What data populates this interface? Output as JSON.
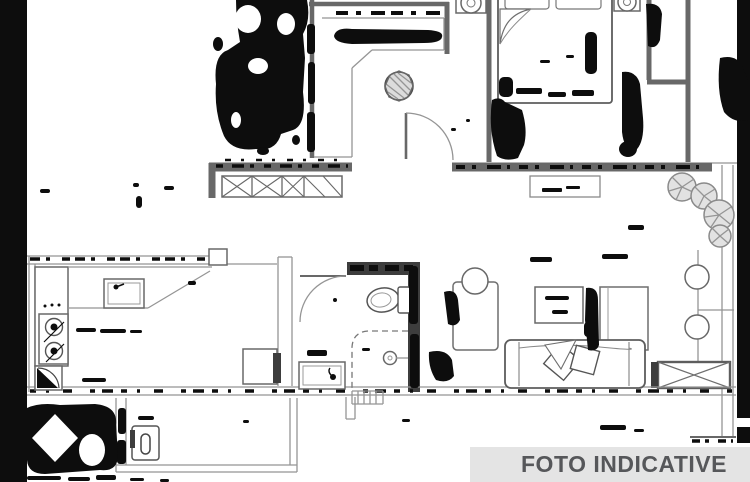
{
  "image": {
    "kind": "apartment floor plan, scanned pencil/ink drawing with heavy smudge artifacts",
    "annotation": "indicative photo watermark banner at bottom right"
  },
  "banner": {
    "label": "FOTO INDICATIVE",
    "background": "#e4e4e4",
    "text_color": "#56575a"
  },
  "colors": {
    "background": "#ffffff",
    "ink": "#0d0d0d",
    "wall": "#686868",
    "thin": "#959595",
    "dark_wall": "#3d3d3d",
    "bar": "#070707"
  },
  "features": [
    "double-bed-with-pillows",
    "nightstand-lamp-left",
    "nightstand-lamp-right",
    "entry-hall",
    "plant-hatched-circle",
    "door-swing-arc-hall",
    "wardrobe-x-hatched",
    "window-sill",
    "balcony-plants",
    "balcony-stools",
    "balcony-railing",
    "kitchen-cooktop",
    "kitchen-sink",
    "kitchen-corner-unit",
    "dining-table",
    "bathroom-toilet",
    "bathroom-shower",
    "bathroom-sink",
    "door-swing-arc-bathroom",
    "living-room-cabinet-left",
    "floor-lamp-circle",
    "coffee-table",
    "living-room-cabinet-right",
    "sofa-with-cushions",
    "crossed-low-cabinet",
    "laundry-appliance",
    "ink-smudge-blobs",
    "scan-edge-bars"
  ]
}
